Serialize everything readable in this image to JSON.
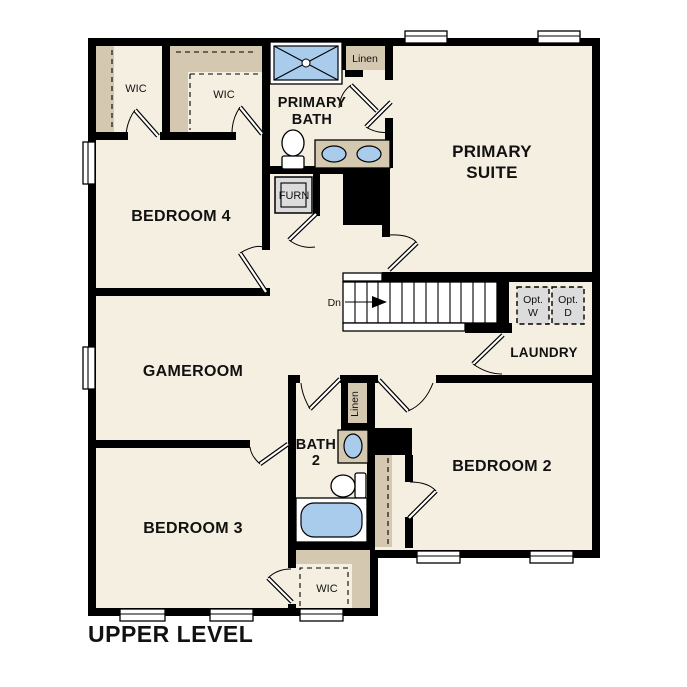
{
  "title": "UPPER LEVEL",
  "colors": {
    "floor": "#f5efe2",
    "wall": "#000000",
    "closet": "#d4c8b0",
    "fixture": "#a9cbec",
    "equipment": "#dcdcdc",
    "background": "#ffffff"
  },
  "rooms": {
    "primary_suite": {
      "line1": "PRIMARY",
      "line2": "SUITE"
    },
    "primary_bath": {
      "line1": "PRIMARY",
      "line2": "BATH"
    },
    "bedroom4": "BEDROOM 4",
    "bedroom3": "BEDROOM 3",
    "bedroom2": "BEDROOM 2",
    "gameroom": "GAMEROOM",
    "laundry": "LAUNDRY",
    "bath2": {
      "line1": "BATH",
      "line2": "2"
    },
    "wic_top_left": "WIC",
    "wic_top_middle": "WIC",
    "wic_bottom": "WIC",
    "linen_top": "Linen",
    "linen_middle": "Linen",
    "furnace": "FURN"
  },
  "stairs": {
    "direction": "Dn"
  },
  "laundry_options": {
    "washer": {
      "line1": "Opt.",
      "line2": "W"
    },
    "dryer": {
      "line1": "Opt.",
      "line2": "D"
    }
  }
}
